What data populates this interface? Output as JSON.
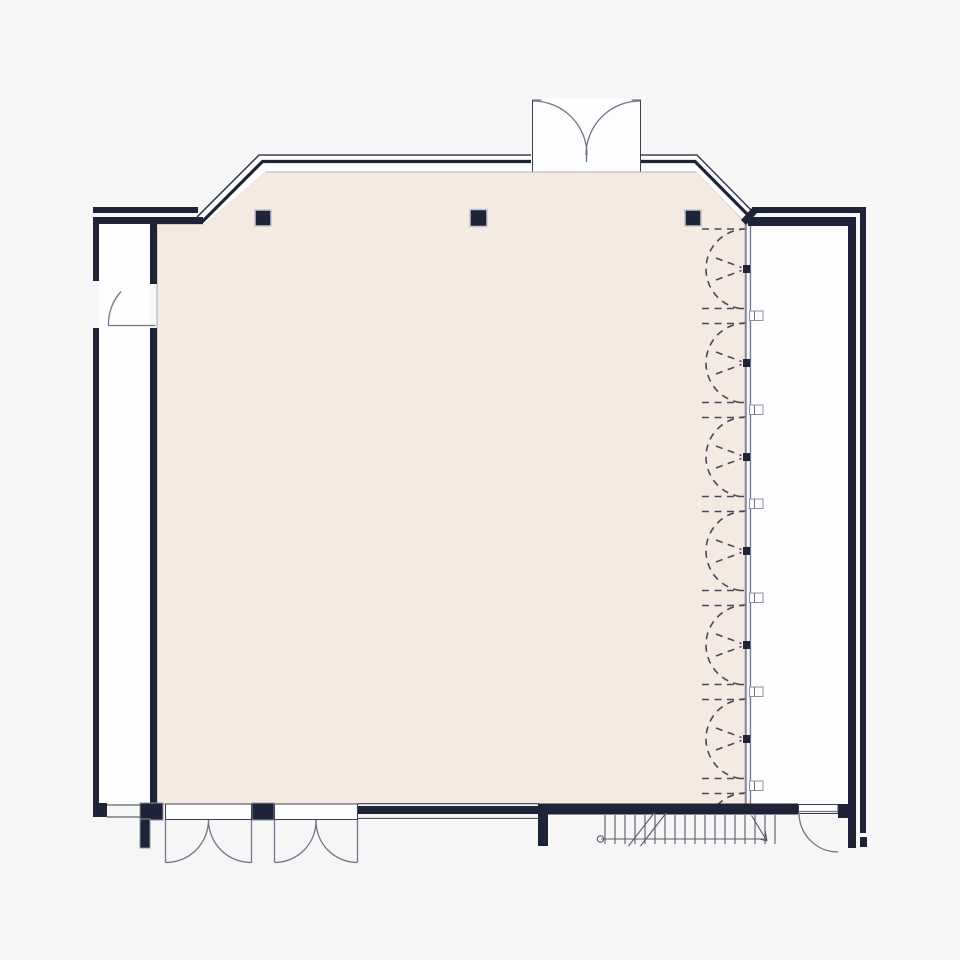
{
  "meta": {
    "type": "architectural-floor-plan",
    "description": "Floor plan of a large hall: top entrance with outward-swinging double doors in a glazed band wall with chamfered corners, a folding accordion partition along the right side, a service corridor on left and right, two double doors at the bottom, a single door at bottom-right and left, and an exterior stair run at the bottom.",
    "visible_text": []
  },
  "palette": {
    "background": "#f6f6f6",
    "room_fill": "#f4eae2",
    "wall": "#1f2337",
    "line_dark": "#3a3f52",
    "line_mid": "#6d7383",
    "door": "#70758a",
    "dash": "#454a5c",
    "track": "#717689",
    "stair": "#565b6c",
    "paper": "#fdfdfe",
    "outline_light": "#aab0bc",
    "column_outline": "#c6c2d0"
  },
  "inventory": {
    "columns": 3,
    "entrance_double_doors": 1,
    "bottom_double_doors": 2,
    "single_doors": 2,
    "partition_bays": 6,
    "partition_brackets": 6,
    "stair_treads": 18
  },
  "partition": {
    "track_x": 746,
    "top_dash_y": 229,
    "dash_x1": 702,
    "dash_x2": 744,
    "arc_radius": 40,
    "bracket_ys": [
      316,
      410,
      504,
      598,
      692,
      786
    ],
    "fold_center_ys": [
      269,
      363,
      457,
      551,
      645,
      739,
      833
    ],
    "clip_bottom": 804
  },
  "stairs": {
    "tread_x_start": 605,
    "tread_step": 10,
    "tread_count": 18,
    "tread_y_top": 815,
    "tread_y_bottom": 844
  }
}
